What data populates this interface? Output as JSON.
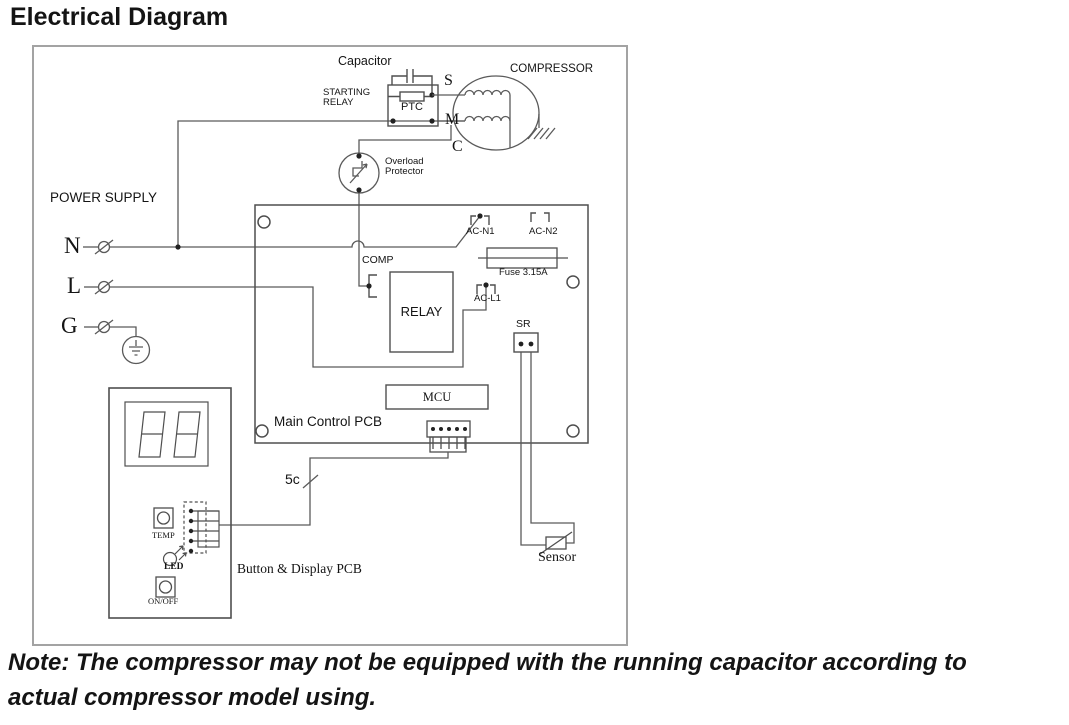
{
  "colors": {
    "wire": "#5a5a5a",
    "outline": "#4f4f4f",
    "border": "#a3a3a3",
    "text": "#141414"
  },
  "title": "Electrical Diagram",
  "note": {
    "line1": "Note: The compressor may not be equipped with the running capacitor according to",
    "line2": "actual compressor model using."
  },
  "diagram": {
    "power": {
      "heading": "POWER SUPPLY",
      "n": "N",
      "l": "L",
      "g": "G"
    },
    "capacitor_label": "Capacitor",
    "starting_relay": {
      "line1": "STARTING",
      "line2": "RELAY",
      "ptc": "PTC"
    },
    "compressor": {
      "label": "COMPRESSOR",
      "s": "S",
      "m": "M",
      "c": "C"
    },
    "overload": {
      "line1": "Overload",
      "line2": "Protector"
    },
    "main_pcb": {
      "label": "Main Control PCB",
      "ac_n1": "AC-N1",
      "ac_n2": "AC-N2",
      "fuse": "Fuse 3.15A",
      "comp": "COMP",
      "relay": "RELAY",
      "ac_l1": "AC-L1",
      "sr": "SR",
      "mcu": "MCU"
    },
    "cable_label": "5c",
    "button_pcb": {
      "label": "Button & Display PCB",
      "temp": "TEMP",
      "led": "LED",
      "on_off": "ON/OFF"
    },
    "sensor_label": "Sensor"
  }
}
